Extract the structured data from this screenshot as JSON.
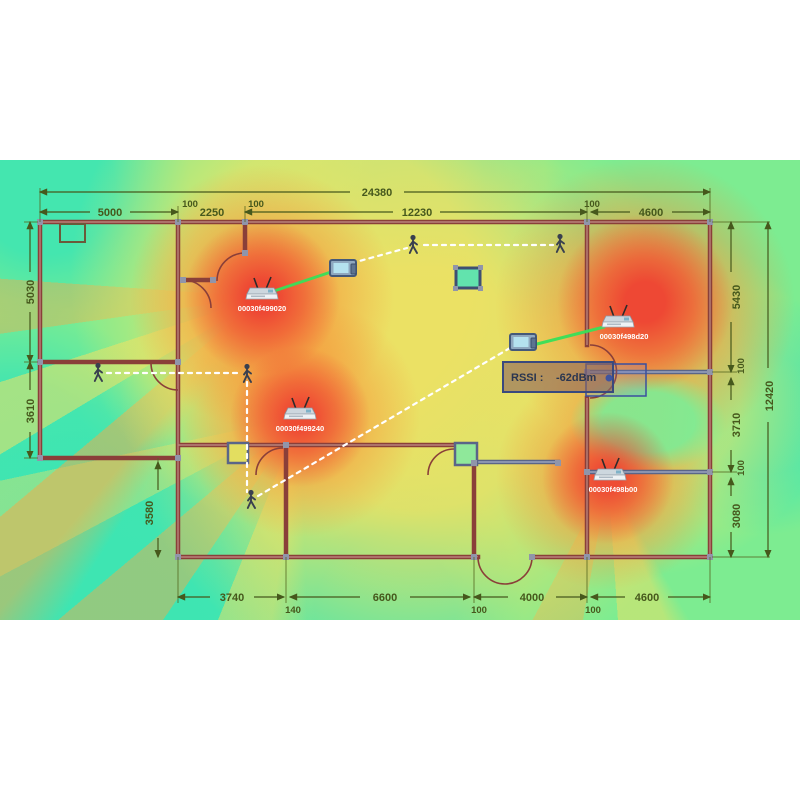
{
  "view": {
    "type": "wifi-coverage-heatmap-floorplan",
    "tooltip": {
      "label": "RSSI :",
      "value": "-62dBm"
    }
  },
  "access_points": [
    {
      "id": "00030f499020"
    },
    {
      "id": "00030f498d20"
    },
    {
      "id": "00030f499240"
    },
    {
      "id": "00030f498b00"
    }
  ],
  "dimensions": {
    "overall_width": "24380",
    "overall_height": "12420",
    "top_row": [
      "5000",
      "100",
      "2250",
      "100",
      "12230",
      "100",
      "4600"
    ],
    "left_col": [
      "5030",
      "3610"
    ],
    "inner_left": "3580",
    "right_col": [
      "5430",
      "100",
      "3710",
      "100",
      "3080"
    ],
    "bottom_row": [
      "3740",
      "140",
      "6600",
      "100",
      "4000",
      "100",
      "4600"
    ]
  },
  "colors": {
    "hot": "#ee4032",
    "warm": "#f6943a",
    "mid": "#f0e062",
    "cool": "#7dec91",
    "cold": "#3ee5b2",
    "link": "#38df58"
  }
}
